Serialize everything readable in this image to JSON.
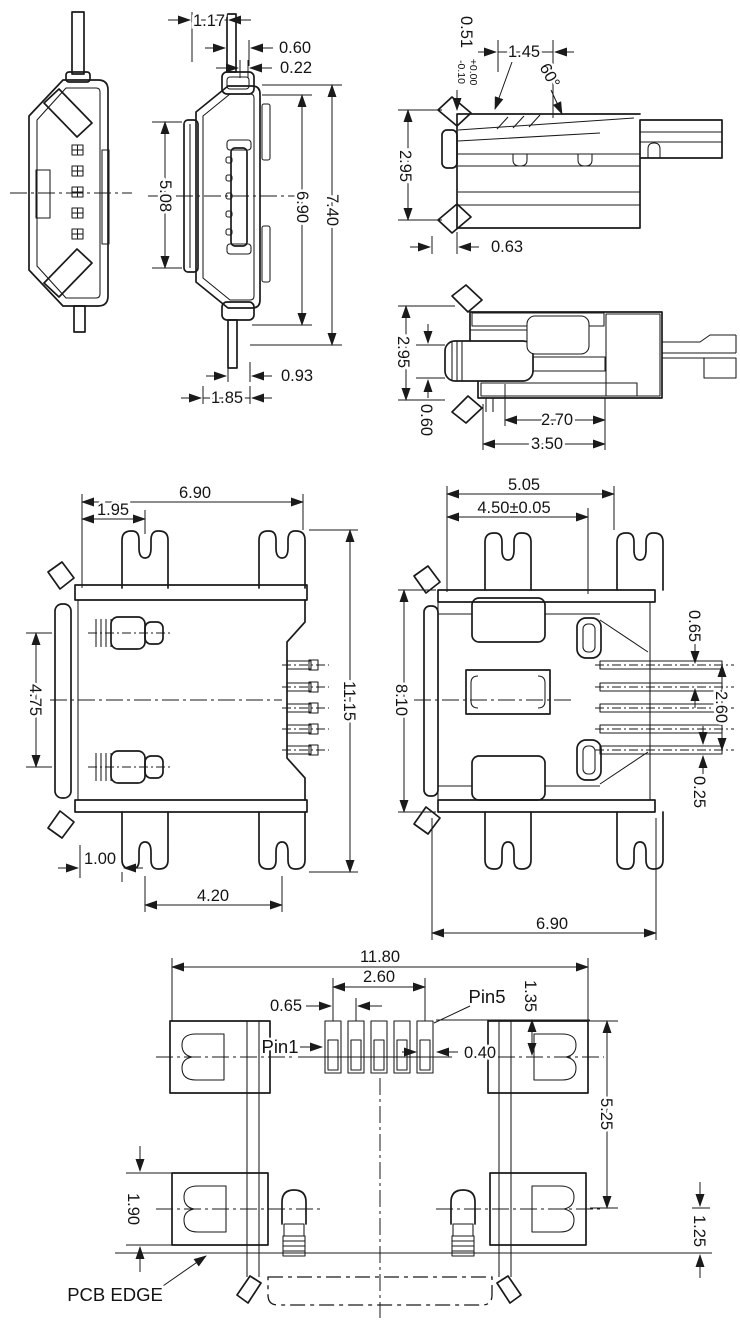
{
  "colors": {
    "stroke": "#1a1a1a",
    "background": "#ffffff"
  },
  "views": {
    "side": {
      "dims": {
        "lead_width": "1.17",
        "tip_offset": "0.60",
        "shell_wall": "0.22",
        "tongue_length": "5.08",
        "body_height": "6.90",
        "overall_height": "7.40",
        "lead_offset": "0.93",
        "base_width": "1.85"
      }
    },
    "rear_profile": {
      "dims": {
        "tab_height": "0.51",
        "tab_tol_plus": "+0.00",
        "tab_tol_minus": "-0.10",
        "latch_offset": "1.45",
        "latch_angle": "60°",
        "height": "2.95",
        "foot_offset": "0.63"
      }
    },
    "section": {
      "dims": {
        "height": "2.95",
        "lip_thickness": "0.60",
        "inner_depth": "2.70",
        "overall_depth": "3.50"
      }
    },
    "top": {
      "dims": {
        "body_width": "6.90",
        "tab_offset": "1.95",
        "leg_spacing": "4.75",
        "overall_length": "11.15",
        "edge_to_tab": "1.00",
        "tab_spacing": "4.20"
      }
    },
    "rear": {
      "dims": {
        "tab_outer_span": "5.05",
        "tab_span": "4.50±0.05",
        "body_length": "8.10",
        "pin_pitch": "0.65",
        "pin_span": "2.60",
        "pin_thickness": "0.25",
        "body_width": "6.90"
      }
    },
    "pcb": {
      "dims": {
        "overall_width": "11.80",
        "pad_span": "2.60",
        "pad_pitch": "0.65",
        "pad_width": "0.40",
        "pad_height": "1.35",
        "pad_row_gap": "5.25",
        "mount_pad_height": "1.90",
        "edge_offset": "1.25"
      },
      "labels": {
        "pin5": "Pin5",
        "pin1": "Pin1",
        "pcb_edge": "PCB EDGE"
      }
    }
  }
}
